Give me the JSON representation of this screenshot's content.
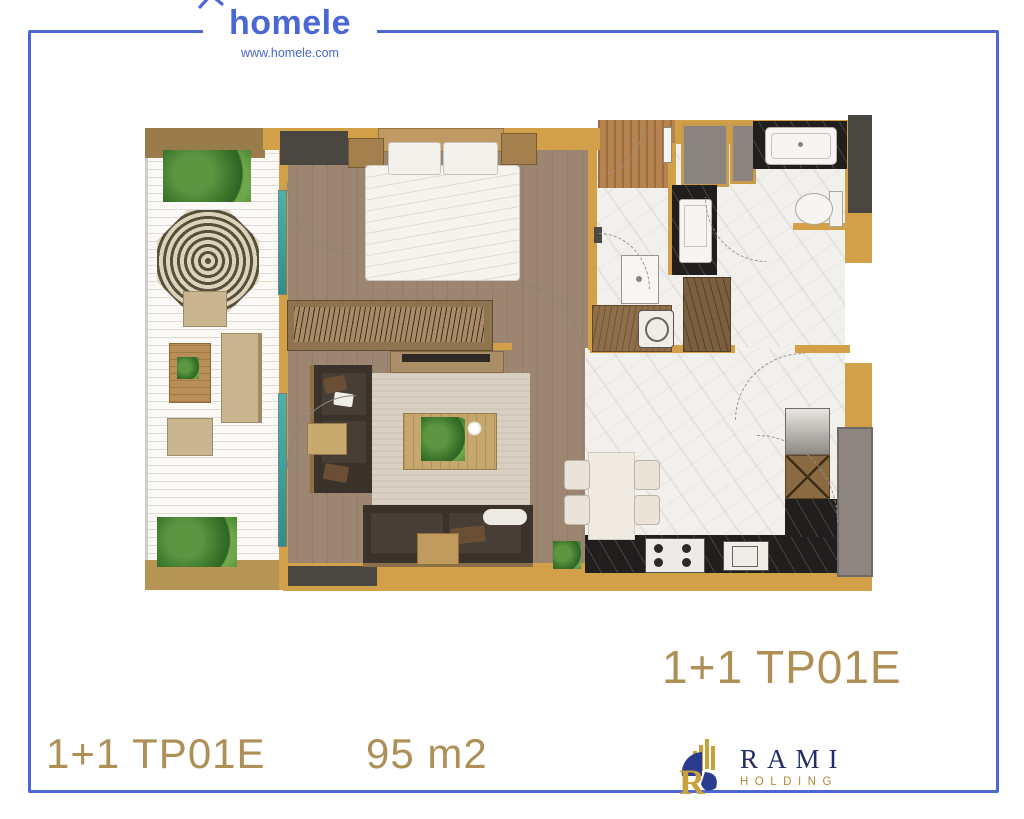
{
  "header": {
    "brand": "homele",
    "website": "www.homele.com"
  },
  "plan": {
    "unit_label_large": "1+1 TP01E",
    "unit_label": "1+1 TP01E",
    "area": "95 m2"
  },
  "footer_logo": {
    "name": "RAMI",
    "subtitle": "HOLDING"
  },
  "icons": {
    "brand_mark": "house-roof-icon",
    "rami_mark": "building-monogram-icon"
  },
  "colors": {
    "accent_blue": "#4A67D3",
    "gold_text": "#AE9057",
    "wall_gold": "#D2A049",
    "balcony_wall": "#9A7C4C",
    "wood_floor": "#9C8672",
    "marble_floor": "#F2F0EC",
    "counter_black": "#211E1E",
    "sofa_dark": "#3A322B",
    "rami_navy": "#232E66",
    "rami_gold": "#B3893B",
    "slider_teal": "#3AA8A0"
  }
}
